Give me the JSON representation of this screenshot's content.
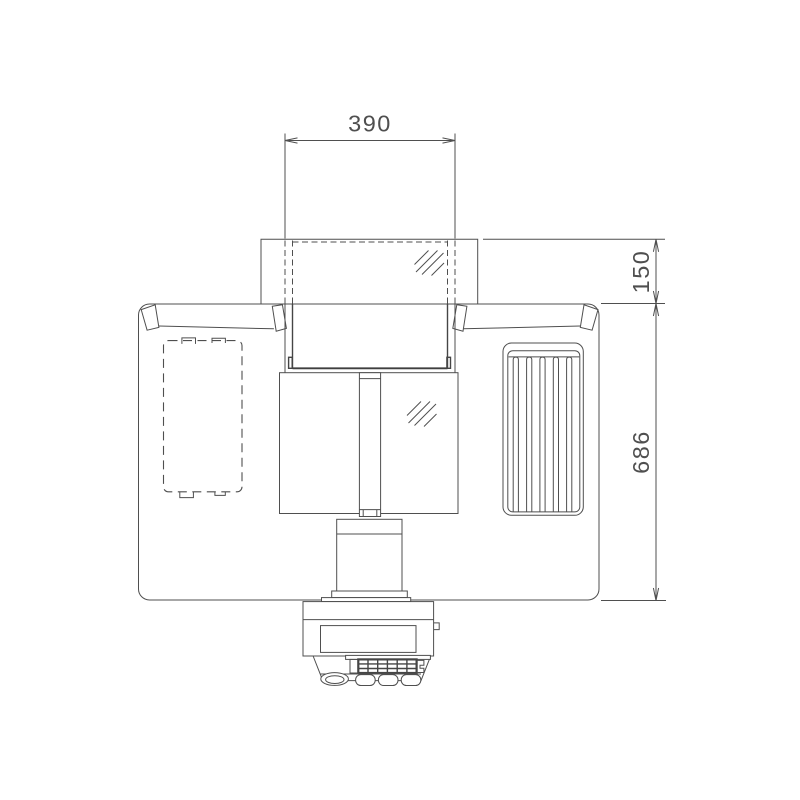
{
  "drawing": {
    "type": "technical-line-drawing",
    "colors": {
      "background": "#ffffff",
      "line": "#4f4f4f",
      "dim_text": "#4f4f4f"
    },
    "dims": {
      "top_width": "390",
      "upper_height": "150",
      "body_height": "686"
    }
  }
}
